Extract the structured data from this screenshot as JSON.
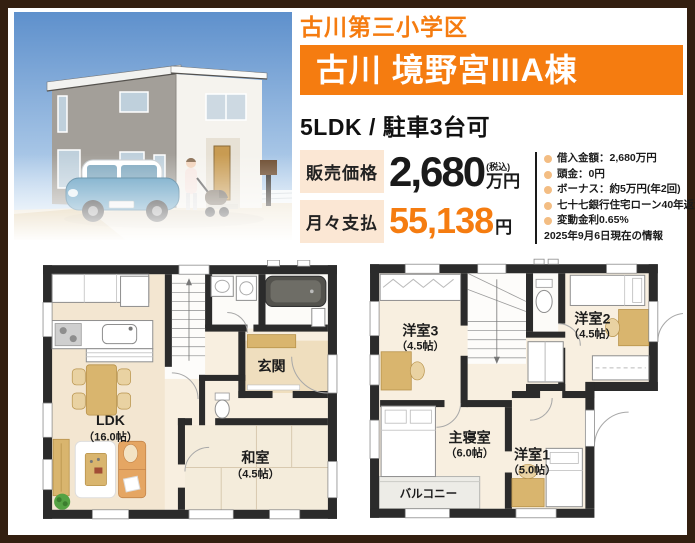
{
  "header": {
    "school_district": "古川第三小学区",
    "property_name": "古川 境野宮IIIA棟",
    "specs": "5LDK / 駐車3台可"
  },
  "pricing": {
    "sale_label": "販売価格",
    "sale_value": "2,680",
    "tax_note": "(税込)",
    "sale_unit": "万円",
    "monthly_label": "月々支払",
    "monthly_value": "55,138",
    "monthly_unit": "円"
  },
  "loan": {
    "items": [
      "借入金額：2,680万円",
      "頭金：0円",
      "ボーナス：約5万円(年2回)",
      "七十七銀行住宅ローン40年返済",
      "変動金利0.65%"
    ],
    "as_of": "2025年9月6日現在の情報"
  },
  "floor_plans": {
    "f1": {
      "ldk": {
        "name": "LDK",
        "size": "（16.0帖）"
      },
      "entrance": {
        "name": "玄関"
      },
      "washitsu": {
        "name": "和室",
        "size": "（4.5帖）"
      }
    },
    "f2": {
      "room3": {
        "name": "洋室3",
        "size": "（4.5帖）"
      },
      "room2": {
        "name": "洋室2",
        "size": "（4.5帖）"
      },
      "master": {
        "name": "主寝室",
        "size": "（6.0帖）"
      },
      "room1": {
        "name": "洋室1",
        "size": "（5.0帖）"
      },
      "balcony": {
        "name": "バルコニー"
      }
    }
  },
  "colors": {
    "accent_orange": "#f57c10",
    "price_label_bg": "#fbe7d4",
    "frame_brown": "#331f10",
    "bullet": "#f3bd83",
    "monthly_value_color": "#f57c10"
  }
}
